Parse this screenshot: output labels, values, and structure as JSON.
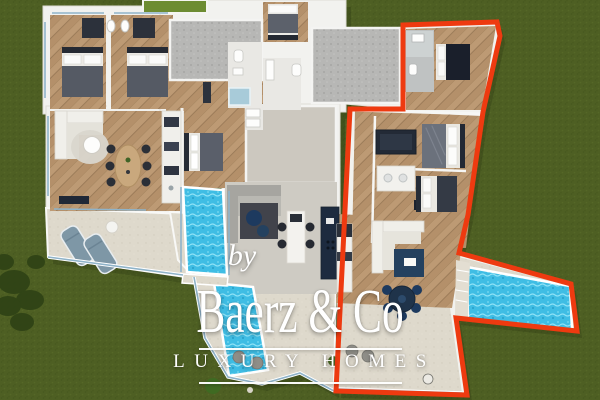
{
  "scene": {
    "description": "Top-down 3D rendered floor plan of a villa with two residences on a green lawn; the right-hand residence and its side pool are traced with a thick red boundary line",
    "units_count": 2,
    "pools_count": 3,
    "highlighted_unit": "right residence"
  },
  "watermark": {
    "by_label": "by",
    "brand": "Baerz & Co",
    "tagline": "LUXURY HOMES"
  },
  "palette": {
    "grass": "#4e5f23",
    "lawn_patch": "#6d8c32",
    "wood_floor": "#b4906a",
    "patio_gray": "#b7b7b5",
    "interior_gray": "#cecbc3",
    "terrace": "#ded9cc",
    "wall_white": "#f2f2ef",
    "pool_water": "#3fbde4",
    "boundary_red": "#ee3a10",
    "navy_accent": "#1d3a5f",
    "watermark_white": "#ffffff"
  }
}
